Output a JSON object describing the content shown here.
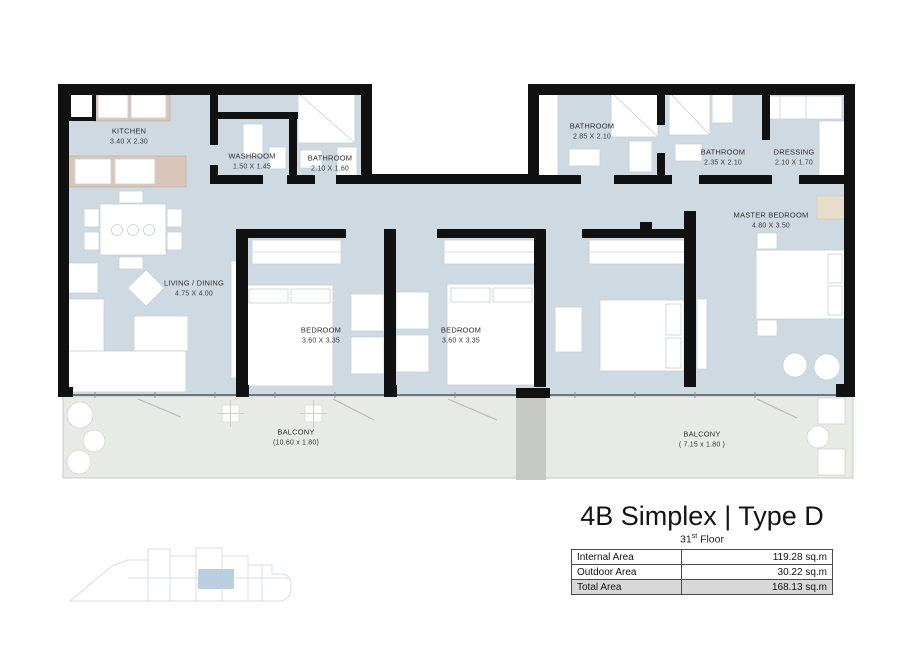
{
  "plan": {
    "title": "4B Simplex | Type D",
    "floor": {
      "number": "31",
      "suffix": "st",
      "word": "Floor"
    },
    "rooms": [
      {
        "id": "kitchen",
        "name": "KITCHEN",
        "dims": "3.40 X 2.30"
      },
      {
        "id": "washroom",
        "name": "WASHROOM",
        "dims": "1.50 X 1.45"
      },
      {
        "id": "bathroom-1",
        "name": "BATHROOM",
        "dims": "2.10 X 1.60"
      },
      {
        "id": "bathroom-2",
        "name": "BATHROOM",
        "dims": "2.85 X 2.10"
      },
      {
        "id": "bathroom-3",
        "name": "BATHROOM",
        "dims": "2.35 X 2.10"
      },
      {
        "id": "dressing",
        "name": "DRESSING",
        "dims": "2.10 X 1.70"
      },
      {
        "id": "master-bedroom",
        "name": "MASTER BEDROOM",
        "dims": "4.80 X 3.50"
      },
      {
        "id": "living-dining",
        "name": "LIVING / DINING",
        "dims": "4.75 X 4.00"
      },
      {
        "id": "bedroom-1",
        "name": "BEDROOM",
        "dims": "3.60 X 3.35"
      },
      {
        "id": "bedroom-2",
        "name": "BEDROOM",
        "dims": "3.60 X 3.35"
      },
      {
        "id": "balcony-1",
        "name": "BALCONY",
        "dims": "(10.60 x 1.80)"
      },
      {
        "id": "balcony-2",
        "name": "BALCONY",
        "dims": "( 7.15 x 1.80 )"
      }
    ],
    "area_table": {
      "rows": [
        {
          "label": "Internal Area",
          "value": "119.28 sq.m"
        },
        {
          "label": "Outdoor Area",
          "value": "30.22 sq.m"
        },
        {
          "label": "Total Area",
          "value": "168.13 sq.m"
        }
      ]
    },
    "colors": {
      "wall": "#111111",
      "floor": "#cfd9e2",
      "balcony": "#e8eae6",
      "kitchen_cabinet": "#d9c6b9",
      "keyplan_highlight": "#b9cfdf"
    }
  }
}
